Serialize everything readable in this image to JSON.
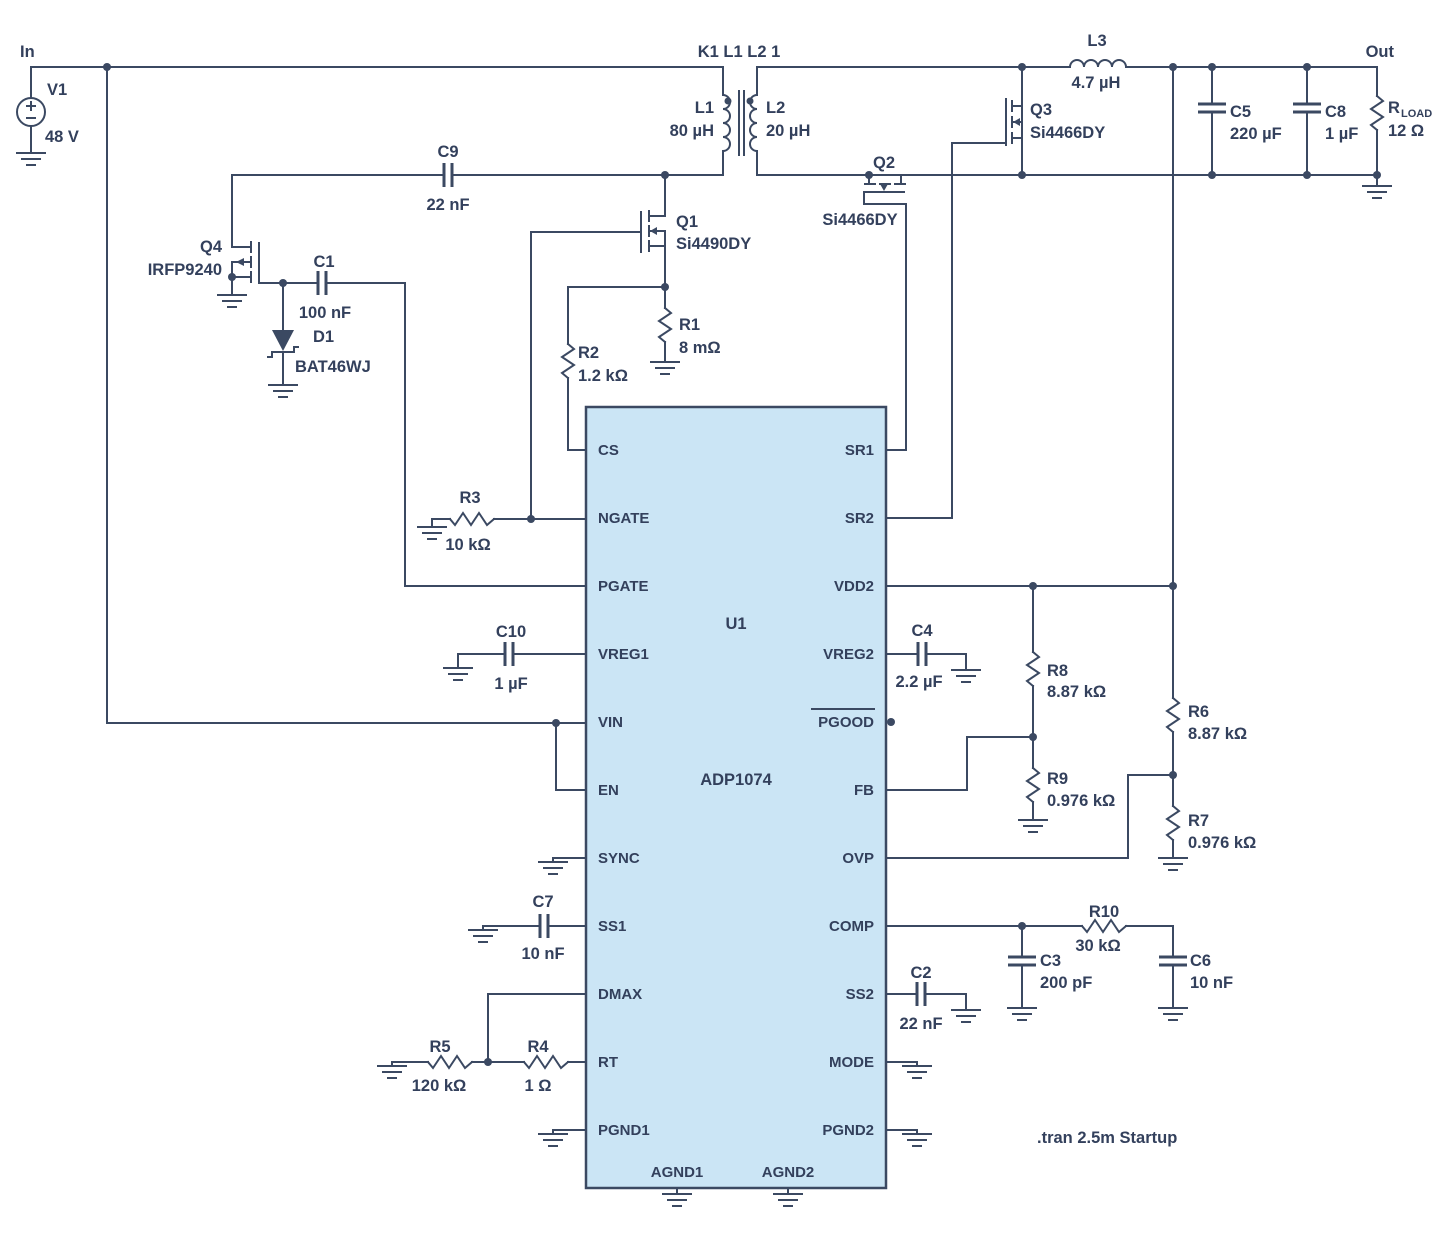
{
  "colors": {
    "wire": "#3b4962",
    "ic_fill": "#cbe5f5",
    "text": "#33405c"
  },
  "io": {
    "in": "In",
    "out": "Out",
    "directive": ".tran 2.5m Startup"
  },
  "source": {
    "ref": "V1",
    "value": "48 V"
  },
  "transformer": {
    "coupling": "K1 L1 L2 1",
    "primary_ref": "L1",
    "primary_value": "80 µH",
    "secondary_ref": "L2",
    "secondary_value": "20 µH"
  },
  "inductors": {
    "l3": {
      "ref": "L3",
      "value": "4.7 µH"
    }
  },
  "mosfets": {
    "q1": {
      "ref": "Q1",
      "part": "Si4490DY"
    },
    "q2": {
      "ref": "Q2",
      "part": "Si4466DY"
    },
    "q3": {
      "ref": "Q3",
      "part": "Si4466DY"
    },
    "q4": {
      "ref": "Q4",
      "part": "IRFP9240"
    }
  },
  "diode": {
    "ref": "D1",
    "part": "BAT46WJ"
  },
  "resistors": {
    "r1": {
      "ref": "R1",
      "value": "8 mΩ"
    },
    "r2": {
      "ref": "R2",
      "value": "1.2 kΩ"
    },
    "r3": {
      "ref": "R3",
      "value": "10 kΩ"
    },
    "r4": {
      "ref": "R4",
      "value": "1 Ω"
    },
    "r5": {
      "ref": "R5",
      "value": "120 kΩ"
    },
    "r6": {
      "ref": "R6",
      "value": "8.87 kΩ"
    },
    "r7": {
      "ref": "R7",
      "value": "0.976 kΩ"
    },
    "r8": {
      "ref": "R8",
      "value": "8.87 kΩ"
    },
    "r9": {
      "ref": "R9",
      "value": "0.976 kΩ"
    },
    "r10": {
      "ref": "R10",
      "value": "30 kΩ"
    },
    "rload": {
      "ref": "R",
      "sub": "LOAD",
      "value": "12 Ω"
    }
  },
  "capacitors": {
    "c1": {
      "ref": "C1",
      "value": "100 nF"
    },
    "c2": {
      "ref": "C2",
      "value": "22 nF"
    },
    "c3": {
      "ref": "C3",
      "value": "200 pF"
    },
    "c4": {
      "ref": "C4",
      "value": "2.2 µF"
    },
    "c5": {
      "ref": "C5",
      "value": "220 µF"
    },
    "c6": {
      "ref": "C6",
      "value": "10 nF"
    },
    "c7": {
      "ref": "C7",
      "value": "10 nF"
    },
    "c8": {
      "ref": "C8",
      "value": "1 µF"
    },
    "c9": {
      "ref": "C9",
      "value": "22 nF"
    },
    "c10": {
      "ref": "C10",
      "value": "1 µF"
    }
  },
  "ic": {
    "ref": "U1",
    "part": "ADP1074",
    "pins_left": [
      "CS",
      "NGATE",
      "PGATE",
      "VREG1",
      "VIN",
      "EN",
      "SYNC",
      "SS1",
      "DMAX",
      "RT",
      "PGND1"
    ],
    "pins_right": [
      "SR1",
      "SR2",
      "VDD2",
      "VREG2",
      "PGOOD",
      "FB",
      "OVP",
      "COMP",
      "SS2",
      "MODE",
      "PGND2"
    ],
    "pins_bottom": [
      "AGND1",
      "AGND2"
    ]
  }
}
